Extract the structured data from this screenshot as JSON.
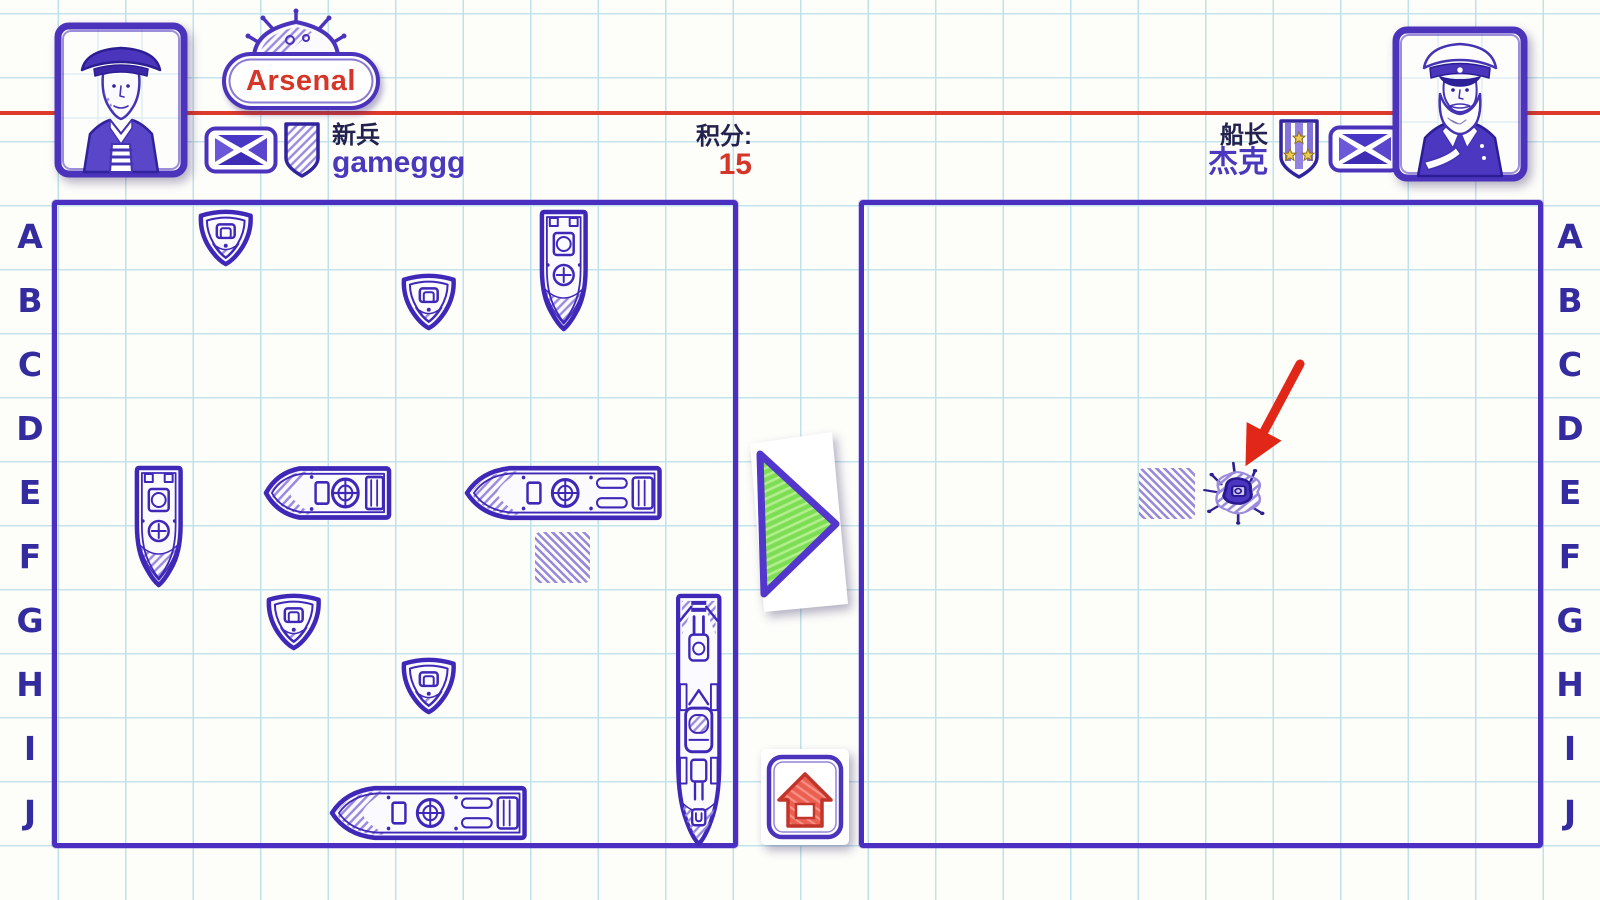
{
  "header": {
    "arsenal_button": "Arsenal",
    "left_player": {
      "rank": "新兵",
      "name": "gameggg"
    },
    "score": {
      "label": "积分:",
      "value": "15"
    },
    "right_player": {
      "rank": "船长",
      "name": "杰克"
    }
  },
  "boards": {
    "row_labels": [
      "A",
      "B",
      "C",
      "D",
      "E",
      "F",
      "G",
      "H",
      "I",
      "J"
    ],
    "left": {
      "ships": [
        {
          "type": "single",
          "cell": "A3"
        },
        {
          "type": "vertical-2",
          "cell": "A8"
        },
        {
          "type": "single",
          "cell": "B6"
        },
        {
          "type": "vertical-2",
          "cell": "E2"
        },
        {
          "type": "horizontal-2",
          "cell": "E4"
        },
        {
          "type": "horizontal-3",
          "cell": "E7"
        },
        {
          "type": "single",
          "cell": "G4"
        },
        {
          "type": "single",
          "cell": "H6"
        },
        {
          "type": "vertical-4",
          "cell": "G10"
        },
        {
          "type": "horizontal-3",
          "cell": "J5"
        }
      ],
      "misses": [
        "F8"
      ]
    },
    "right": {
      "sunk_ships": [
        {
          "type": "sunk-1",
          "cell": "E6"
        }
      ],
      "misses": [
        "E5"
      ],
      "arrow_target_cell": "E6"
    }
  },
  "icons": {
    "mine": "naval-mine-icon",
    "left_flag": "saltire-flag-icon",
    "left_badge": "recruit-shield-badge-icon",
    "right_badge": "captain-stars-badge-icon",
    "right_flag": "saltire-flag-icon",
    "play": "play-arrow-icon",
    "home": "home-icon",
    "pointer": "red-pointer-arrow-icon"
  },
  "colors": {
    "ink": "#4128bc",
    "paper_line": "#bfe2ea",
    "accent_red": "#dd3a2c",
    "play_green": "#7ddd55",
    "badge_gold": "#eecb52",
    "name_purple": "#4a39bc",
    "dark_text": "#23214e"
  }
}
